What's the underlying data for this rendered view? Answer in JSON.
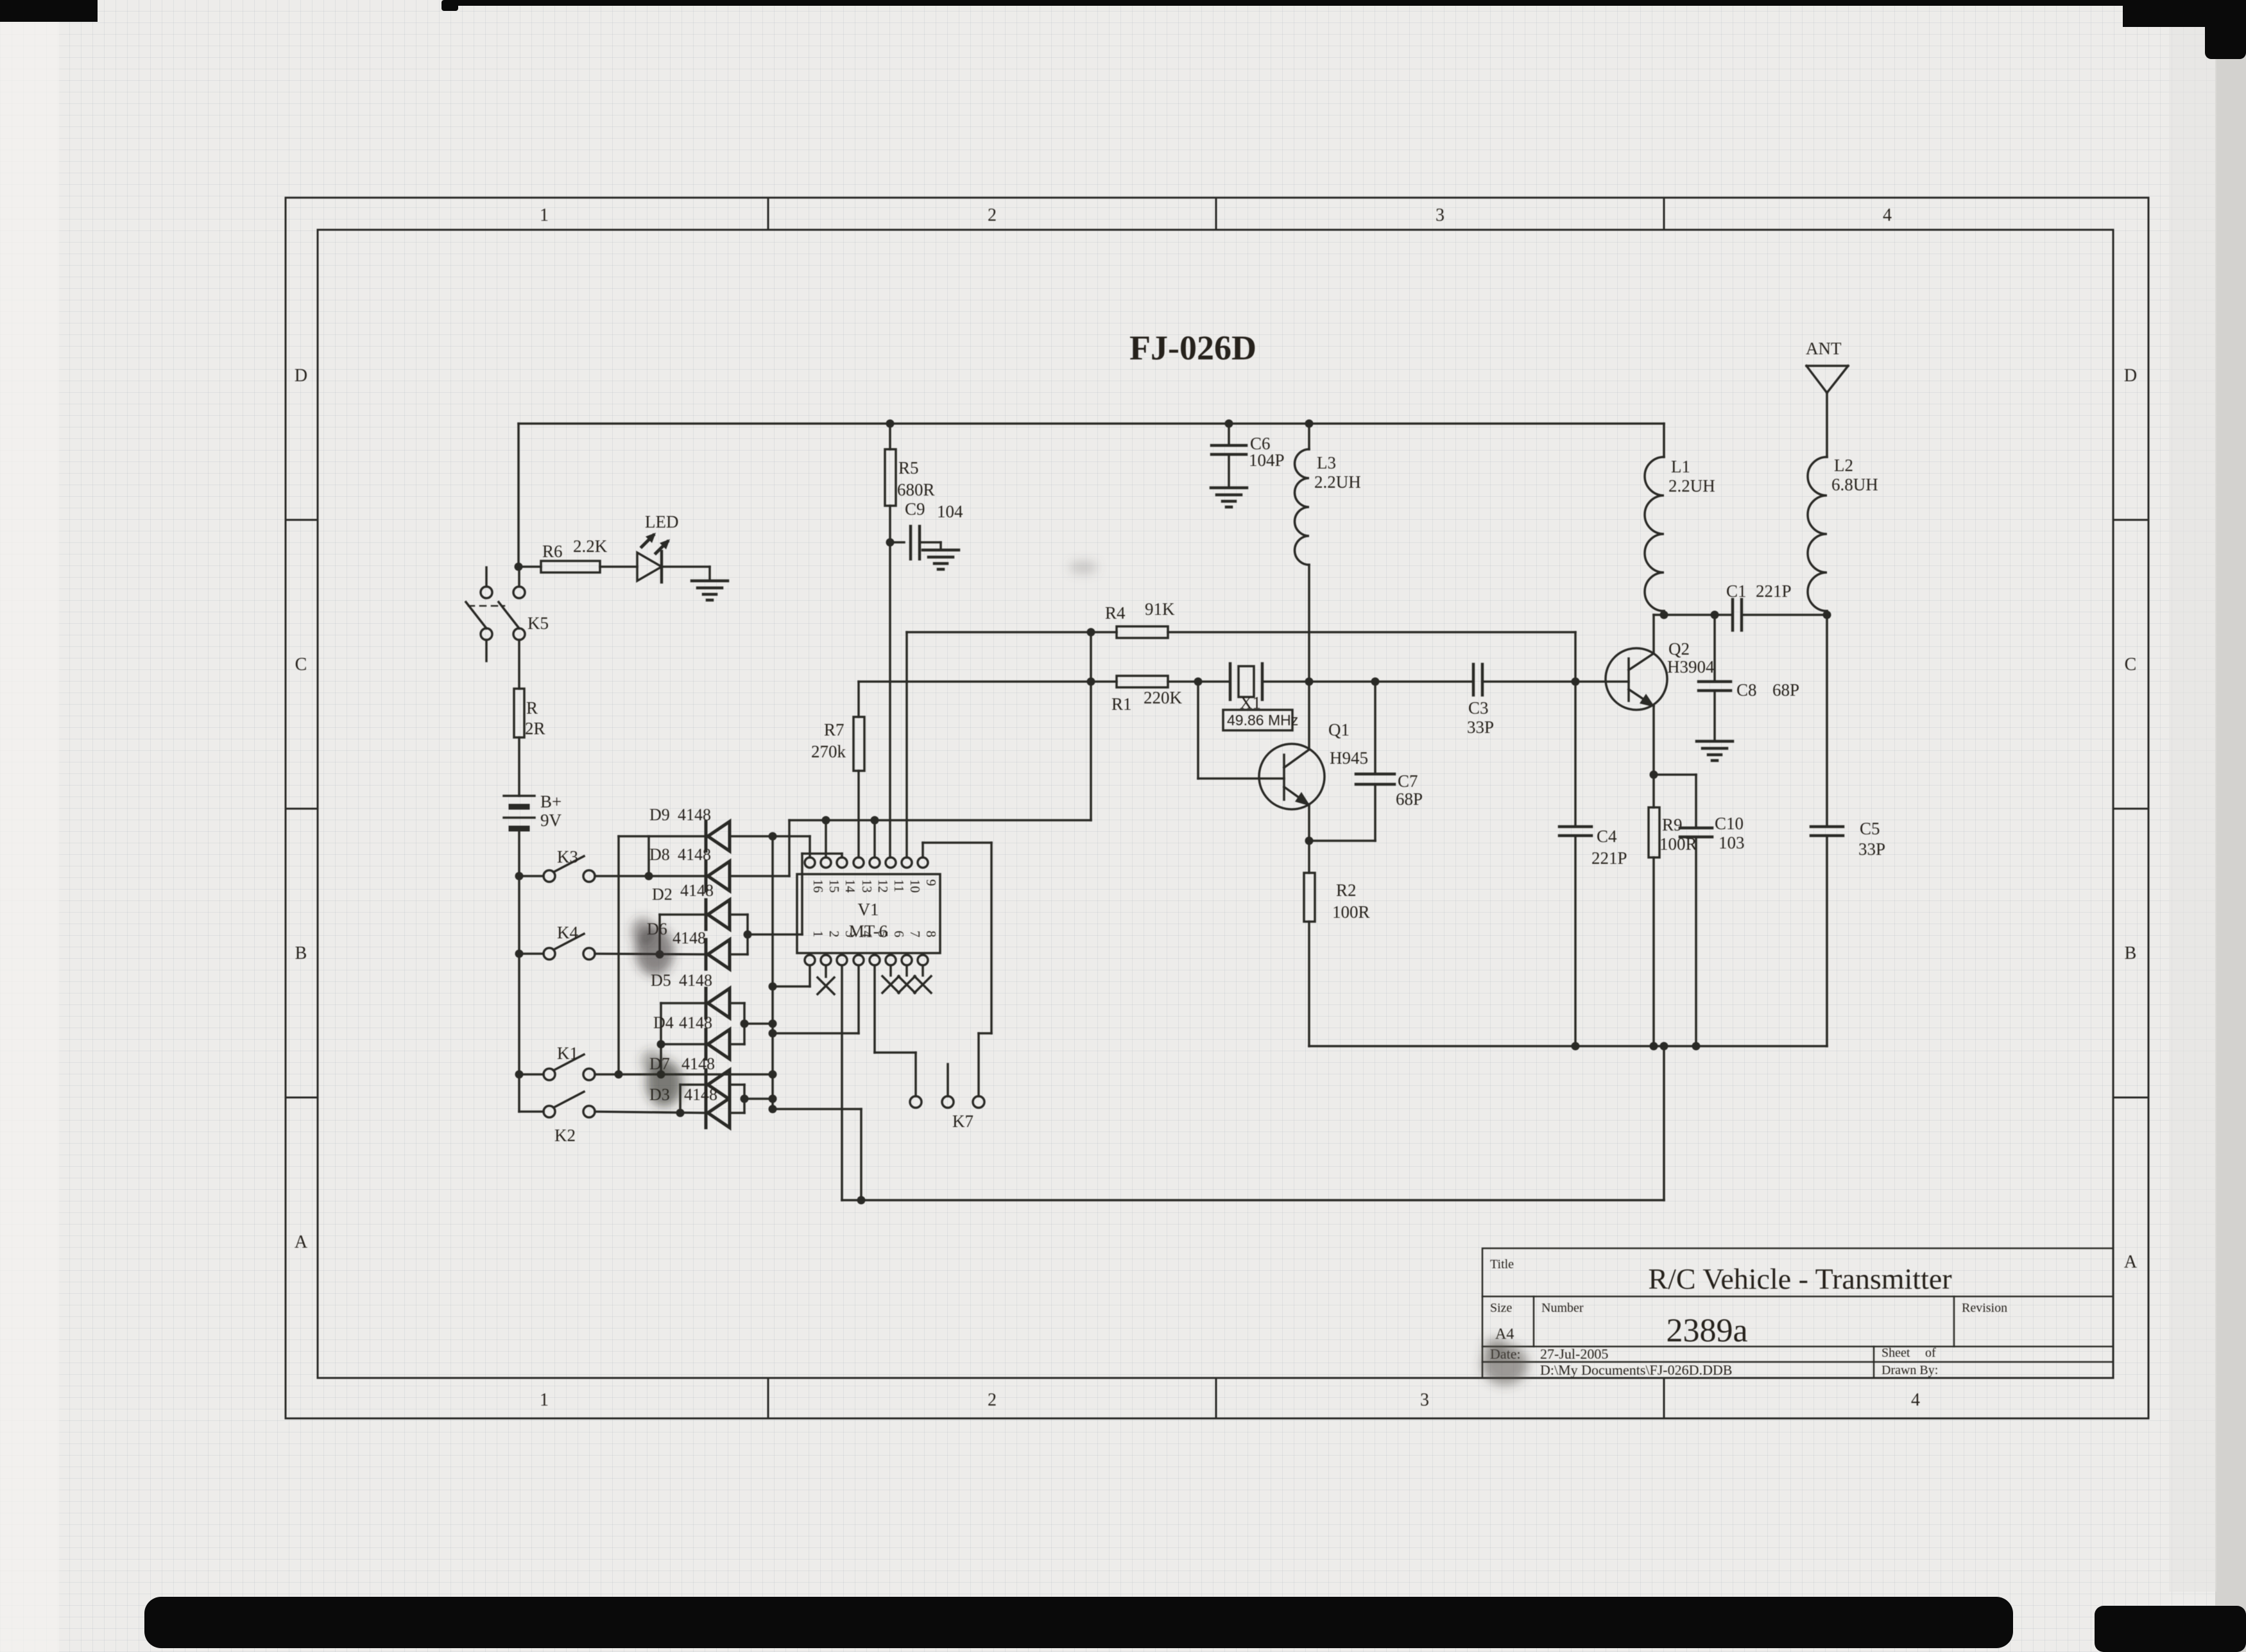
{
  "colors": {
    "paper": "#edecea",
    "ink": "#2b2927"
  },
  "sheet": {
    "title": "FJ-026D",
    "cols": [
      "1",
      "2",
      "3",
      "4"
    ],
    "rows": [
      "D",
      "C",
      "B",
      "A"
    ]
  },
  "title_block": {
    "title_label": "Title",
    "title": "R/C Vehicle - Transmitter",
    "size_label": "Size",
    "size": "A4",
    "number_label": "Number",
    "number": "2389a",
    "revision_label": "Revision",
    "date_label": "Date:",
    "date": "27-Jul-2005",
    "file": "D:\\My Documents\\FJ-026D.DDB",
    "sheet_label": "Sheet",
    "of_label": "of",
    "drawn_by_label": "Drawn By:"
  },
  "ic": {
    "top_pins": [
      "16",
      "15",
      "14",
      "13",
      "12",
      "11",
      "10",
      "9"
    ],
    "bottom_pins": [
      "1",
      "2",
      "3",
      "4",
      "5",
      "6",
      "7",
      "8"
    ]
  },
  "components": {
    "r6": {
      "ref": "R6",
      "value": "2.2K"
    },
    "led": {
      "ref": "LED"
    },
    "k5": {
      "ref": "K5"
    },
    "r_limit": {
      "ref": "R",
      "value": "2R"
    },
    "battery": {
      "ref": "B+",
      "value": "9V"
    },
    "k3": {
      "ref": "K3"
    },
    "k4": {
      "ref": "K4"
    },
    "k1": {
      "ref": "K1"
    },
    "k2": {
      "ref": "K2"
    },
    "k7": {
      "ref": "K7"
    },
    "d9": {
      "ref": "D9",
      "value": "4148"
    },
    "d8": {
      "ref": "D8",
      "value": "4148"
    },
    "d2": {
      "ref": "D2",
      "value": "4148"
    },
    "d6": {
      "ref": "D6",
      "value": "4148"
    },
    "d5": {
      "ref": "D5",
      "value": "4148"
    },
    "d4": {
      "ref": "D4",
      "value": "4148"
    },
    "d7": {
      "ref": "D7",
      "value": "4148"
    },
    "d3": {
      "ref": "D3",
      "value": "4148"
    },
    "v1": {
      "ref": "V1",
      "value": "MT-6"
    },
    "r7": {
      "ref": "R7",
      "value": "270k"
    },
    "r5": {
      "ref": "R5",
      "value": "680R"
    },
    "c9": {
      "ref": "C9",
      "value": "104"
    },
    "r4": {
      "ref": "R4",
      "value": "91K"
    },
    "r1": {
      "ref": "R1",
      "value": "220K"
    },
    "x1": {
      "ref": "X1",
      "value": "49.86 MHz"
    },
    "q1": {
      "ref": "Q1",
      "value": "H945"
    },
    "c7": {
      "ref": "C7",
      "value": "68P"
    },
    "r2": {
      "ref": "R2",
      "value": "100R"
    },
    "c6": {
      "ref": "C6",
      "value": "104P"
    },
    "l3": {
      "ref": "L3",
      "value": "2.2UH"
    },
    "c3": {
      "ref": "C3",
      "value": "33P"
    },
    "q2": {
      "ref": "Q2",
      "value": "H3904"
    },
    "c1": {
      "ref": "C1",
      "value": "221P"
    },
    "c8": {
      "ref": "C8",
      "value": "68P"
    },
    "c4": {
      "ref": "C4",
      "value": "221P"
    },
    "r9": {
      "ref": "R9",
      "value": "100R"
    },
    "c10": {
      "ref": "C10",
      "value": "103"
    },
    "c5": {
      "ref": "C5",
      "value": "33P"
    },
    "l1": {
      "ref": "L1",
      "value": "2.2UH"
    },
    "l2": {
      "ref": "L2",
      "value": "6.8UH"
    },
    "ant": {
      "ref": "ANT"
    }
  }
}
